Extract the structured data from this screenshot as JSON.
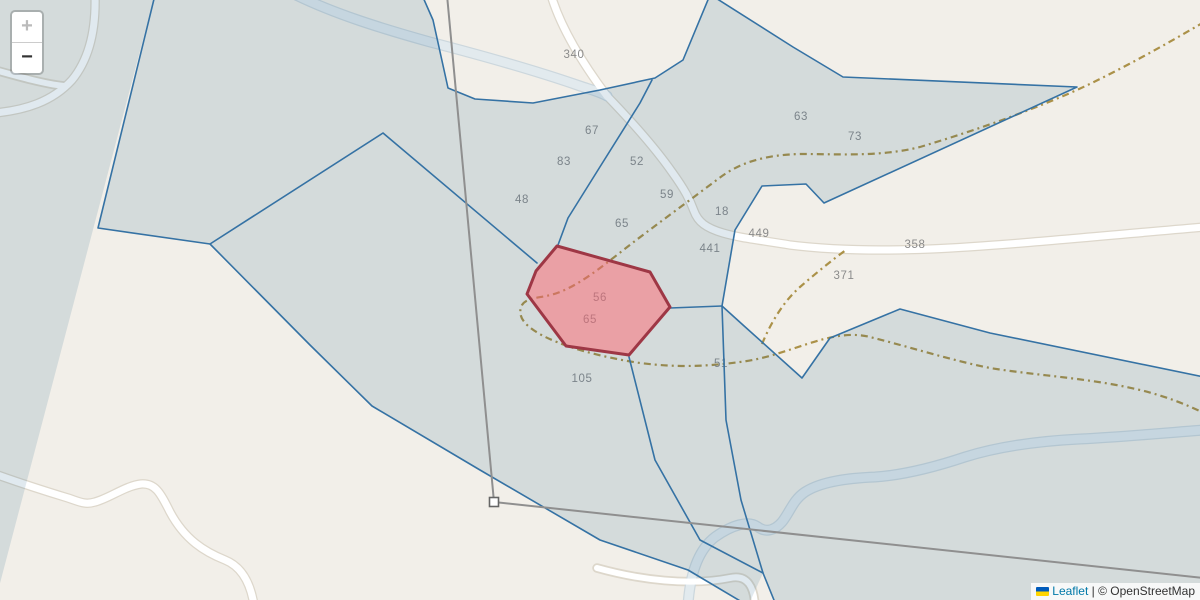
{
  "map": {
    "colors": {
      "bg_beige": "#f2efe9",
      "parcel_fill": "rgba(16,84,128,0.13)",
      "parcel_stroke": "#3572a4",
      "selected_fill": "rgba(255,102,112,0.5)",
      "selected_stroke": "#9e3745",
      "road_fill": "#ffffff",
      "road_casing": "#ddd7cb",
      "stream_fill": "#e2eaee",
      "stream_casing": "#ccd7dd",
      "track_dash": "#ab9148",
      "measure_line": "#8f8f8f",
      "tile_label": "#8b8b8b",
      "link_blue": "#0078A8",
      "flag_blue": "#005BBB",
      "flag_yellow": "#FFD500"
    },
    "tile_labels": [
      {
        "text": "340",
        "x": 574,
        "y": 58
      },
      {
        "text": "67",
        "x": 592,
        "y": 134
      },
      {
        "text": "83",
        "x": 564,
        "y": 165
      },
      {
        "text": "52",
        "x": 637,
        "y": 165
      },
      {
        "text": "48",
        "x": 522,
        "y": 203
      },
      {
        "text": "59",
        "x": 667,
        "y": 198
      },
      {
        "text": "65",
        "x": 622,
        "y": 227
      },
      {
        "text": "18",
        "x": 722,
        "y": 215
      },
      {
        "text": "441",
        "x": 710,
        "y": 252
      },
      {
        "text": "449",
        "x": 759,
        "y": 237
      },
      {
        "text": "358",
        "x": 915,
        "y": 248
      },
      {
        "text": "371",
        "x": 844,
        "y": 279
      },
      {
        "text": "63",
        "x": 801,
        "y": 120
      },
      {
        "text": "73",
        "x": 855,
        "y": 140
      },
      {
        "text": "56",
        "x": 600,
        "y": 301
      },
      {
        "text": "65",
        "x": 590,
        "y": 323
      },
      {
        "text": "105",
        "x": 582,
        "y": 382
      },
      {
        "text": "51",
        "x": 721,
        "y": 367
      }
    ],
    "selected_parcel_labels": [
      "56",
      "65"
    ]
  },
  "controls": {
    "zoom_in_label": "+",
    "zoom_out_label": "−"
  },
  "attribution": {
    "flag_name": "ukraine-flag",
    "leaflet_label": "Leaflet",
    "separator": " | ",
    "copyright_label": "© OpenStreetMap"
  }
}
